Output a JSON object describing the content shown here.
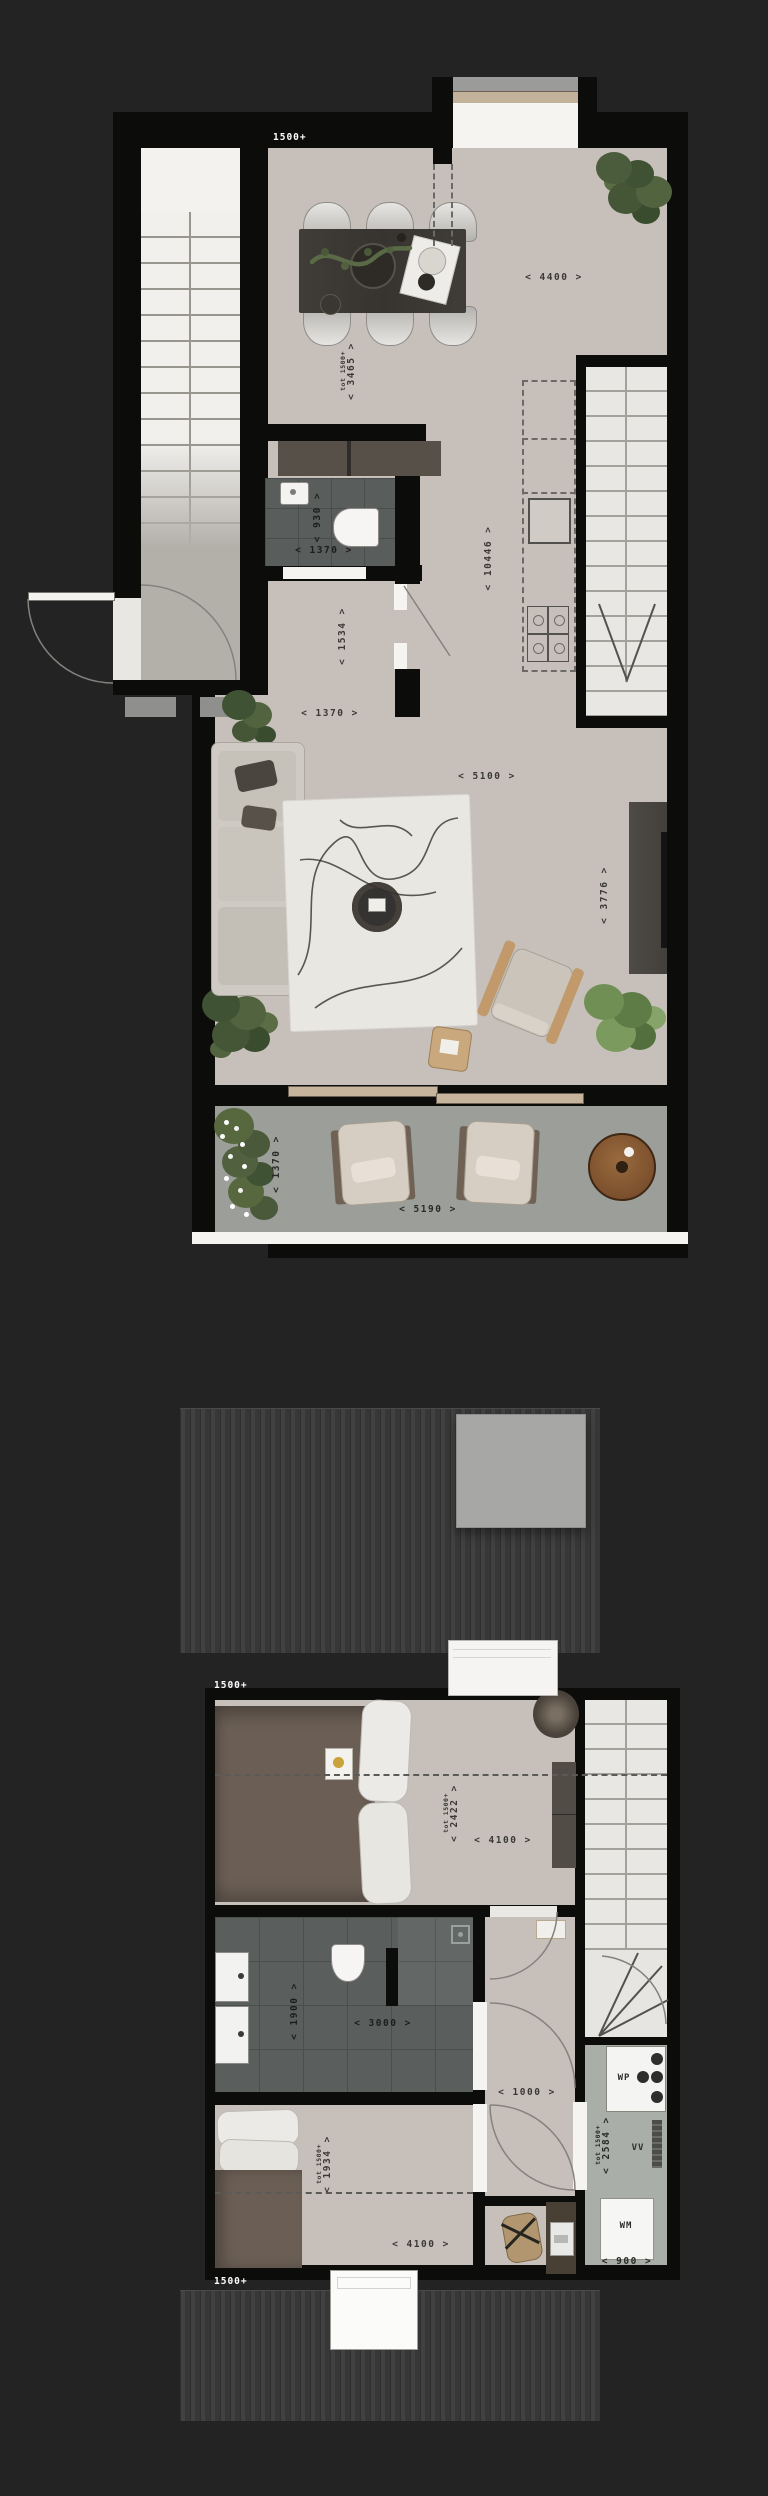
{
  "drawing": {
    "type": "architectural floor plans, two levels, dark presentation style",
    "colors": {
      "background": "#232323",
      "wall": "#0c0c0b",
      "floor_beige": "#c7c0ba",
      "bathroom_tile": "#595d5b",
      "terrace": "#9b9e99",
      "stair": "#f1f0ed",
      "roof": "#373737",
      "table_wood": "#3e3a35",
      "bed_duvet": "#6b5f55",
      "plant_green": "#50613d",
      "terrace_table": "#8a5a33",
      "label_dark": "#3a3936",
      "label_light": "#ffffff",
      "tech_floor": "#a9aea9"
    }
  },
  "floor1": {
    "level_marker": "1500+",
    "dims": {
      "dining_width": "< 4400 >",
      "dining_depth": "< 3465 >",
      "dining_depth_note": "tot 1500+",
      "total_length": "< 10446 >",
      "wc_width": "< 930 >",
      "wc_length": "< 1370 >",
      "hall_depth": "< 1534 >",
      "hall_width": "< 1370 >",
      "living_width": "< 5100 >",
      "living_depth": "< 3776 >",
      "terrace_depth": "< 1370 >",
      "terrace_width": "< 5190 >"
    }
  },
  "floor2": {
    "level_marker_top": "1500+",
    "level_marker_bottom": "1500+",
    "dims": {
      "bedroom1_depth": "< 2422 >",
      "bedroom1_depth_note": "tot 1500+",
      "bedroom1_width": "< 4100 >",
      "bathroom_depth": "< 1900 >",
      "bathroom_width": "< 3000 >",
      "landing_width": "< 1000 >",
      "bedroom2_depth": "< 1934 >",
      "bedroom2_depth_note": "tot 1500+",
      "bedroom2_width": "< 4100 >",
      "tech_depth": "< 2584 >",
      "tech_depth_note": "tot 1500+",
      "tech_width": "< 900 >"
    },
    "equipment": {
      "heat_pump": "WP",
      "ventilation": "VV",
      "washing_machine": "WM"
    }
  }
}
